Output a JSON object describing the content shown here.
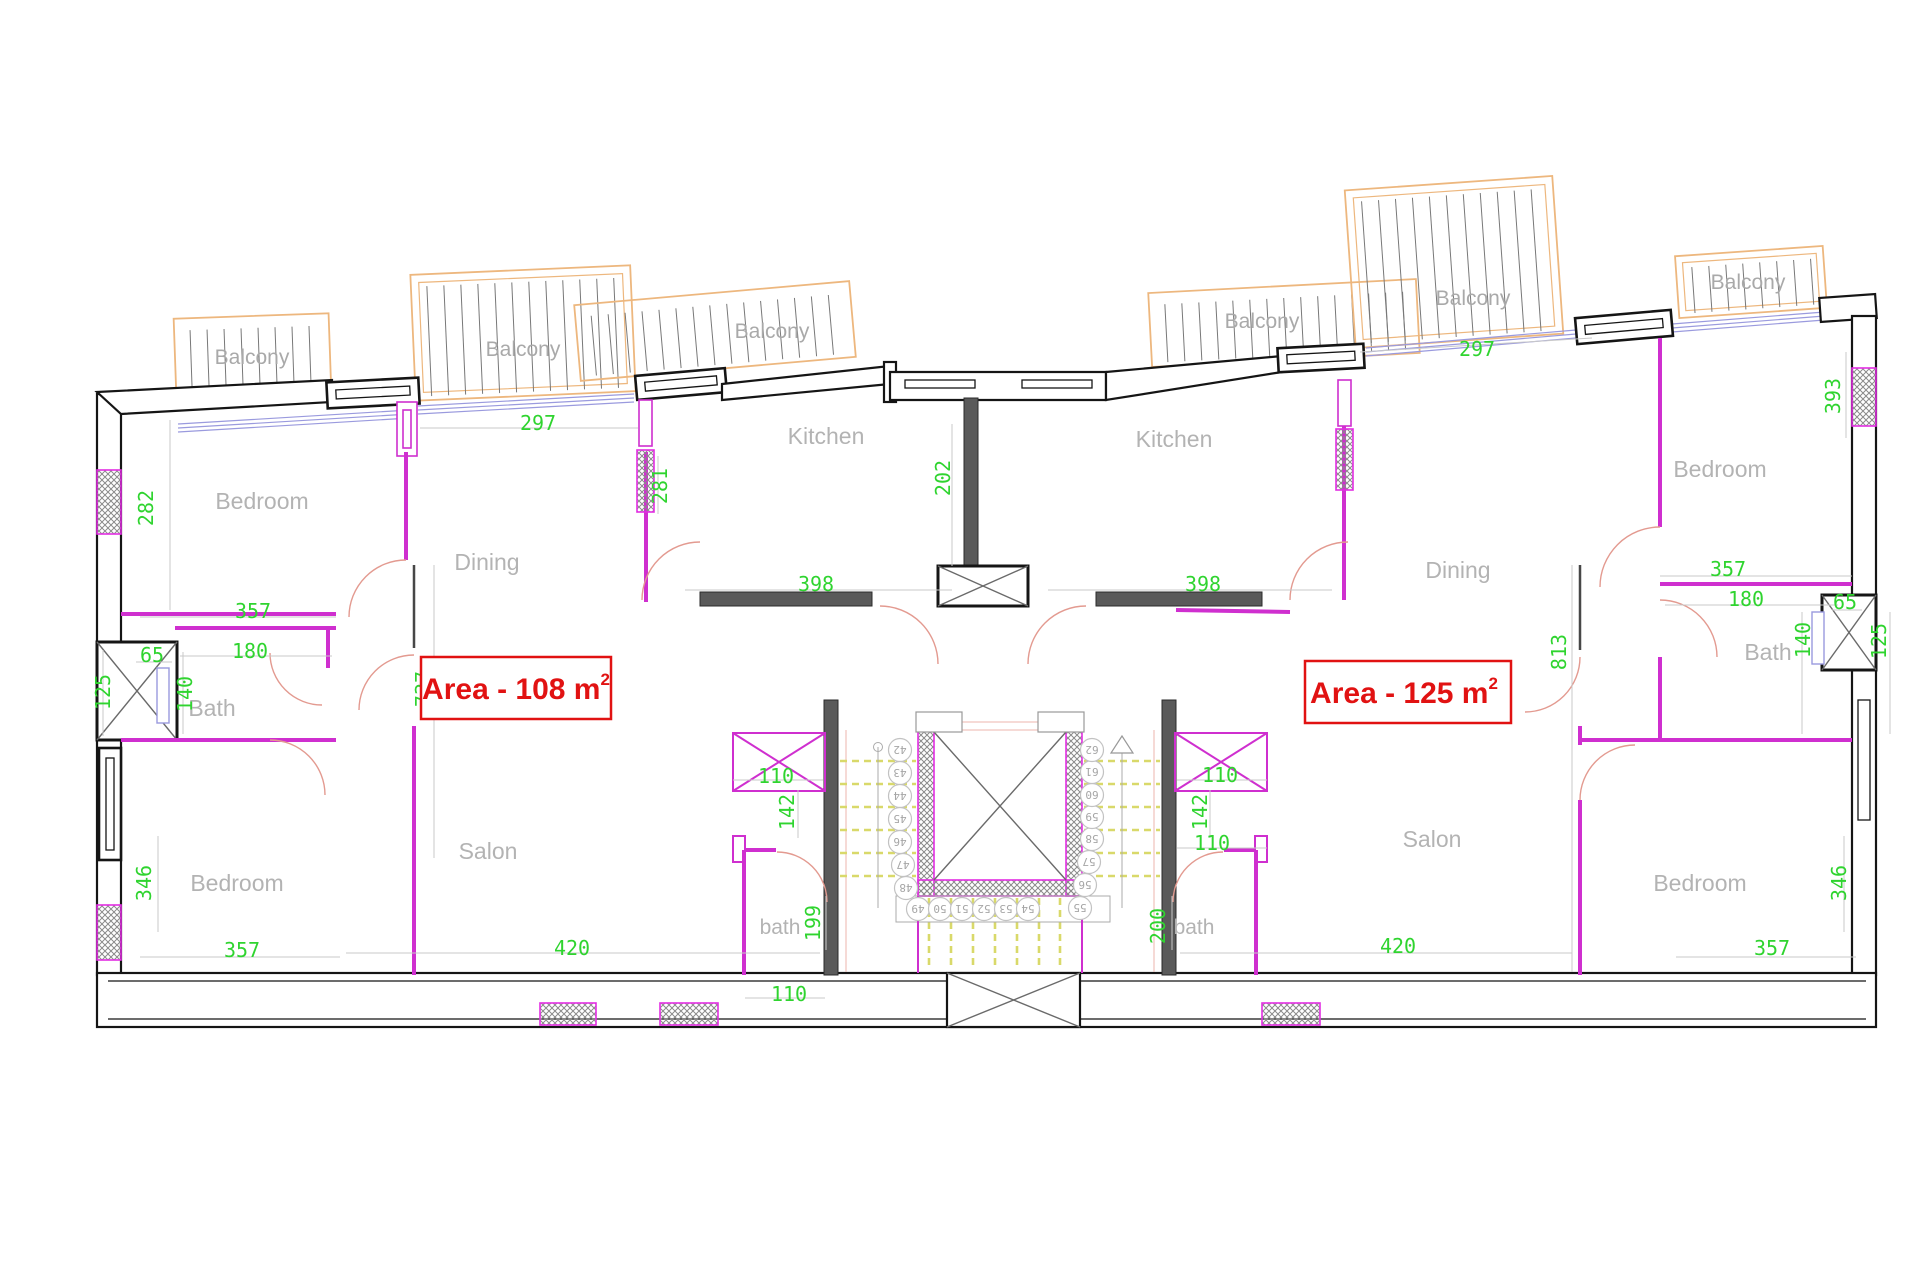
{
  "colors": {
    "wall_black": "#151515",
    "wall_dark_gray": "#5a5a5a",
    "wall_magenta": "#cf2fcf",
    "balcony_orange": "#edb77e",
    "door_salmon": "#e39a90",
    "glazing_blue": "#9a9ade",
    "stair_yellow": "#d9d96a",
    "dimension_green": "#2fd42f",
    "label_gray": "#b3b3b3",
    "area_red": "#e11212"
  },
  "areas": {
    "left": {
      "label": "Area - 108 m",
      "sup": "2"
    },
    "right": {
      "label": "Area - 125 m",
      "sup": "2"
    }
  },
  "room_labels": [
    {
      "text": "Bedroom",
      "x": 262,
      "y": 509,
      "small": false
    },
    {
      "text": "Dining",
      "x": 487,
      "y": 570,
      "small": false
    },
    {
      "text": "Kitchen",
      "x": 826,
      "y": 444,
      "small": false
    },
    {
      "text": "Kitchen",
      "x": 1174,
      "y": 447,
      "small": false
    },
    {
      "text": "Dining",
      "x": 1458,
      "y": 578,
      "small": false
    },
    {
      "text": "Bedroom",
      "x": 1720,
      "y": 477,
      "small": false
    },
    {
      "text": "Bath",
      "x": 212,
      "y": 716,
      "small": false
    },
    {
      "text": "Bath",
      "x": 1768,
      "y": 660,
      "small": false
    },
    {
      "text": "Bedroom",
      "x": 237,
      "y": 891,
      "small": false
    },
    {
      "text": "Salon",
      "x": 488,
      "y": 859,
      "small": false
    },
    {
      "text": "Salon",
      "x": 1432,
      "y": 847,
      "small": false
    },
    {
      "text": "Bedroom",
      "x": 1700,
      "y": 891,
      "small": false
    },
    {
      "text": "bath",
      "x": 780,
      "y": 934,
      "small": true
    },
    {
      "text": "bath",
      "x": 1194,
      "y": 934,
      "small": true
    }
  ],
  "balcony_labels": [
    {
      "text": "Balcony",
      "x": 252,
      "y": 364
    },
    {
      "text": "Balcony",
      "x": 523,
      "y": 356
    },
    {
      "text": "Balcony",
      "x": 772,
      "y": 338
    },
    {
      "text": "Balcony",
      "x": 1262,
      "y": 328
    },
    {
      "text": "Balcony",
      "x": 1473,
      "y": 305
    },
    {
      "text": "Balcony",
      "x": 1748,
      "y": 289
    }
  ],
  "dimensions": [
    {
      "text": "282",
      "x": 153,
      "y": 508,
      "v": true
    },
    {
      "text": "297",
      "x": 538,
      "y": 430,
      "v": false
    },
    {
      "text": "281",
      "x": 667,
      "y": 486,
      "v": true
    },
    {
      "text": "202",
      "x": 950,
      "y": 478,
      "v": true
    },
    {
      "text": "357",
      "x": 253,
      "y": 618,
      "v": false
    },
    {
      "text": "180",
      "x": 250,
      "y": 658,
      "v": false
    },
    {
      "text": "65",
      "x": 152,
      "y": 662,
      "v": false
    },
    {
      "text": "125",
      "x": 110,
      "y": 692,
      "v": true
    },
    {
      "text": "140",
      "x": 192,
      "y": 694,
      "v": true
    },
    {
      "text": "737",
      "x": 430,
      "y": 689,
      "v": true
    },
    {
      "text": "398",
      "x": 816,
      "y": 591,
      "v": false
    },
    {
      "text": "110",
      "x": 776,
      "y": 783,
      "v": false
    },
    {
      "text": "142",
      "x": 794,
      "y": 812,
      "v": true
    },
    {
      "text": "199",
      "x": 820,
      "y": 923,
      "v": true
    },
    {
      "text": "110",
      "x": 789,
      "y": 1001,
      "v": false
    },
    {
      "text": "346",
      "x": 151,
      "y": 883,
      "v": true
    },
    {
      "text": "357",
      "x": 242,
      "y": 957,
      "v": false
    },
    {
      "text": "420",
      "x": 572,
      "y": 955,
      "v": false
    },
    {
      "text": "398",
      "x": 1203,
      "y": 591,
      "v": false
    },
    {
      "text": "297",
      "x": 1477,
      "y": 356,
      "v": false
    },
    {
      "text": "393",
      "x": 1840,
      "y": 396,
      "v": true
    },
    {
      "text": "357",
      "x": 1728,
      "y": 576,
      "v": false
    },
    {
      "text": "180",
      "x": 1746,
      "y": 606,
      "v": false
    },
    {
      "text": "65",
      "x": 1845,
      "y": 609,
      "v": false
    },
    {
      "text": "140",
      "x": 1810,
      "y": 640,
      "v": true
    },
    {
      "text": "125",
      "x": 1886,
      "y": 641,
      "v": true
    },
    {
      "text": "813",
      "x": 1566,
      "y": 652,
      "v": true
    },
    {
      "text": "110",
      "x": 1220,
      "y": 782,
      "v": false
    },
    {
      "text": "142",
      "x": 1207,
      "y": 812,
      "v": true
    },
    {
      "text": "110",
      "x": 1212,
      "y": 850,
      "v": false
    },
    {
      "text": "200",
      "x": 1165,
      "y": 926,
      "v": true
    },
    {
      "text": "420",
      "x": 1398,
      "y": 953,
      "v": false
    },
    {
      "text": "346",
      "x": 1846,
      "y": 883,
      "v": true
    },
    {
      "text": "357",
      "x": 1772,
      "y": 955,
      "v": false
    }
  ],
  "stair_steps": [
    {
      "n": "42",
      "x": 900,
      "y": 750
    },
    {
      "n": "43",
      "x": 900,
      "y": 773
    },
    {
      "n": "44",
      "x": 900,
      "y": 796
    },
    {
      "n": "45",
      "x": 900,
      "y": 819
    },
    {
      "n": "46",
      "x": 900,
      "y": 842
    },
    {
      "n": "47",
      "x": 903,
      "y": 865
    },
    {
      "n": "48",
      "x": 906,
      "y": 888
    },
    {
      "n": "49",
      "x": 918,
      "y": 909
    },
    {
      "n": "50",
      "x": 940,
      "y": 909
    },
    {
      "n": "51",
      "x": 962,
      "y": 909
    },
    {
      "n": "52",
      "x": 984,
      "y": 909
    },
    {
      "n": "53",
      "x": 1006,
      "y": 909
    },
    {
      "n": "54",
      "x": 1028,
      "y": 909
    },
    {
      "n": "55",
      "x": 1080,
      "y": 908
    },
    {
      "n": "56",
      "x": 1085,
      "y": 885
    },
    {
      "n": "57",
      "x": 1089,
      "y": 862
    },
    {
      "n": "58",
      "x": 1092,
      "y": 839
    },
    {
      "n": "59",
      "x": 1092,
      "y": 817
    },
    {
      "n": "60",
      "x": 1092,
      "y": 795
    },
    {
      "n": "61",
      "x": 1092,
      "y": 772
    },
    {
      "n": "62",
      "x": 1092,
      "y": 750
    }
  ]
}
